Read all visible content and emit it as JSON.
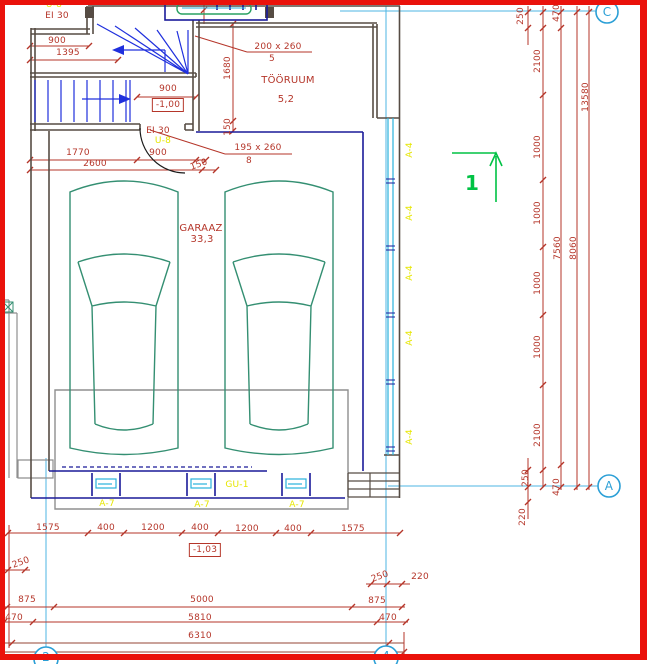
{
  "drawing": {
    "type": "architectural-floor-plan",
    "rooms": [
      {
        "name": "GARAAZ",
        "area": "33,3"
      },
      {
        "name": "TÖÖRUUM",
        "area": "5,2"
      }
    ],
    "levels": [
      "-1,00",
      "-1,03"
    ],
    "grid_axes": [
      "C",
      "A",
      "2",
      "4"
    ],
    "door_marks": [
      {
        "size": "200 x 260",
        "number": "5"
      },
      {
        "size": "195 x 260",
        "number": "8"
      }
    ],
    "component_tags": [
      "U-8",
      "A-4",
      "A-7",
      "GU-1"
    ],
    "fire_rating": "EI 30",
    "section_mark": "1",
    "colors": {
      "dimension_red": "#b5362a",
      "tag_yellow": "#e6e600",
      "grid_blue": "#2b9fd6",
      "section_green": "#00c244",
      "wall_dark": "#564c44",
      "wall_navy": "#1a1a99",
      "stair_blue": "#2030dd",
      "glazing_cyan": "#29b2dd",
      "car_teal": "#348f72",
      "frame_red": "#ea120b"
    }
  },
  "labels": [
    {
      "t": "U-8",
      "x": 54,
      "y": 5,
      "c": "y",
      "n": "door-tag"
    },
    {
      "t": "EI 30",
      "x": 57,
      "y": 16,
      "n": "fire-rating"
    },
    {
      "t": "900",
      "x": 57,
      "y": 41
    },
    {
      "t": "1395",
      "x": 68,
      "y": 53
    },
    {
      "t": "900",
      "x": 168,
      "y": 89
    },
    {
      "t": "-1,00",
      "x": 168,
      "y": 105,
      "box": 1,
      "n": "level-marker"
    },
    {
      "t": "EI 30",
      "x": 158,
      "y": 131,
      "n": "fire-rating"
    },
    {
      "t": "U-8",
      "x": 163,
      "y": 141,
      "c": "y",
      "n": "door-tag"
    },
    {
      "t": "1770",
      "x": 78,
      "y": 153
    },
    {
      "t": "900",
      "x": 158,
      "y": 153
    },
    {
      "t": "150",
      "x": 199,
      "y": 165,
      "rot": -20
    },
    {
      "t": "2600",
      "x": 95,
      "y": 164
    },
    {
      "t": "200 x 260",
      "x": 278,
      "y": 47,
      "n": "door-size"
    },
    {
      "t": "5",
      "x": 272,
      "y": 59,
      "n": "door-number"
    },
    {
      "t": "TÖÖRUUM",
      "x": 288,
      "y": 81,
      "fs": 10,
      "n": "room-name"
    },
    {
      "t": "5,2",
      "x": 286,
      "y": 100,
      "fs": 10,
      "n": "room-area"
    },
    {
      "t": "1680",
      "x": 228,
      "y": 68,
      "rot": -90
    },
    {
      "t": "150",
      "x": 228,
      "y": 127,
      "rot": -90
    },
    {
      "t": "195 x 260",
      "x": 258,
      "y": 148,
      "n": "door-size"
    },
    {
      "t": "8",
      "x": 249,
      "y": 161,
      "n": "door-number"
    },
    {
      "t": "GARAAZ",
      "x": 201,
      "y": 229,
      "fs": 10,
      "n": "room-name"
    },
    {
      "t": "33,3",
      "x": 202,
      "y": 240,
      "fs": 10,
      "n": "room-area"
    },
    {
      "t": "250",
      "x": 521,
      "y": 16,
      "rot": -90
    },
    {
      "t": "470",
      "x": 557,
      "y": 13,
      "rot": -90
    },
    {
      "t": "2100",
      "x": 538,
      "y": 61,
      "rot": -90
    },
    {
      "t": "13580",
      "x": 586,
      "y": 97,
      "rot": -90
    },
    {
      "t": "1000",
      "x": 538,
      "y": 147,
      "rot": -90
    },
    {
      "t": "1000",
      "x": 538,
      "y": 213,
      "rot": -90
    },
    {
      "t": "7560",
      "x": 558,
      "y": 248,
      "rot": -90
    },
    {
      "t": "8060",
      "x": 574,
      "y": 248,
      "rot": -90
    },
    {
      "t": "1000",
      "x": 538,
      "y": 283,
      "rot": -90
    },
    {
      "t": "1000",
      "x": 538,
      "y": 347,
      "rot": -90
    },
    {
      "t": "2100",
      "x": 538,
      "y": 435,
      "rot": -90
    },
    {
      "t": "250",
      "x": 526,
      "y": 478,
      "rot": -90
    },
    {
      "t": "470",
      "x": 557,
      "y": 487,
      "rot": -90
    },
    {
      "t": "220",
      "x": 523,
      "y": 517,
      "rot": -90
    },
    {
      "t": "1575",
      "x": 48,
      "y": 528
    },
    {
      "t": "400",
      "x": 106,
      "y": 528
    },
    {
      "t": "1200",
      "x": 153,
      "y": 528
    },
    {
      "t": "400",
      "x": 200,
      "y": 528
    },
    {
      "t": "1200",
      "x": 247,
      "y": 529
    },
    {
      "t": "400",
      "x": 293,
      "y": 529
    },
    {
      "t": "1575",
      "x": 353,
      "y": 529
    },
    {
      "t": "-1,03",
      "x": 205,
      "y": 550,
      "box": 1,
      "n": "level-marker"
    },
    {
      "t": "250",
      "x": 21,
      "y": 563,
      "rot": -20
    },
    {
      "t": "250",
      "x": 380,
      "y": 577,
      "rot": -20
    },
    {
      "t": "220",
      "x": 420,
      "y": 577
    },
    {
      "t": "875",
      "x": 27,
      "y": 600
    },
    {
      "t": "5000",
      "x": 202,
      "y": 600
    },
    {
      "t": "875",
      "x": 377,
      "y": 601
    },
    {
      "t": "470",
      "x": 14,
      "y": 618
    },
    {
      "t": "5810",
      "x": 200,
      "y": 618
    },
    {
      "t": "470",
      "x": 388,
      "y": 618
    },
    {
      "t": "6310",
      "x": 200,
      "y": 636
    },
    {
      "t": "A-4",
      "x": 410,
      "y": 150,
      "c": "y",
      "rot": -90,
      "n": "window-tag"
    },
    {
      "t": "A-4",
      "x": 410,
      "y": 213,
      "c": "y",
      "rot": -90,
      "n": "window-tag"
    },
    {
      "t": "A-4",
      "x": 410,
      "y": 273,
      "c": "y",
      "rot": -90,
      "n": "window-tag"
    },
    {
      "t": "A-4",
      "x": 410,
      "y": 338,
      "c": "y",
      "rot": -90,
      "n": "window-tag"
    },
    {
      "t": "A-4",
      "x": 410,
      "y": 437,
      "c": "y",
      "rot": -90,
      "n": "window-tag"
    },
    {
      "t": "GU-1",
      "x": 237,
      "y": 485,
      "c": "y",
      "n": "garage-door-tag"
    },
    {
      "t": "A-7",
      "x": 107,
      "y": 504,
      "c": "y",
      "n": "component-tag"
    },
    {
      "t": "A-7",
      "x": 202,
      "y": 505,
      "c": "y",
      "n": "component-tag"
    },
    {
      "t": "A-7",
      "x": 297,
      "y": 505,
      "c": "y",
      "n": "component-tag"
    },
    {
      "t": "1",
      "x": 472,
      "y": 183,
      "c": "g",
      "fs": 20,
      "n": "section-number"
    },
    {
      "t": "C",
      "x": 607,
      "y": 12,
      "c": "b",
      "fs": 12,
      "n": "grid-label"
    },
    {
      "t": "A",
      "x": 609,
      "y": 486,
      "c": "b",
      "fs": 12,
      "n": "grid-label"
    },
    {
      "t": "2",
      "x": 46,
      "y": 657,
      "c": "b",
      "fs": 12,
      "n": "grid-label"
    },
    {
      "t": "4",
      "x": 386,
      "y": 656,
      "c": "b",
      "fs": 12,
      "n": "grid-label"
    }
  ]
}
